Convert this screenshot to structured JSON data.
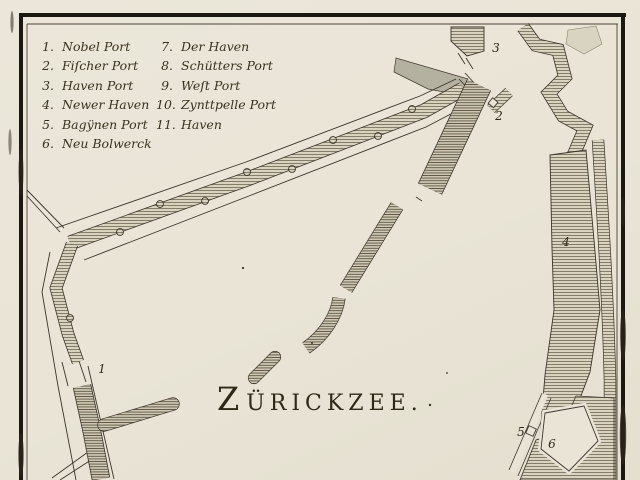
{
  "map": {
    "title": "ZÜRICKZEE.",
    "legend": {
      "col1": [
        {
          "num": "1.",
          "label": "Nobel Port"
        },
        {
          "num": "2.",
          "label": "Fiſcher Port"
        },
        {
          "num": "3.",
          "label": "Haven Port"
        },
        {
          "num": "4.",
          "label": "Newer Haven"
        },
        {
          "num": "5.",
          "label": "Bagÿnen Port"
        },
        {
          "num": "6.",
          "label": "Neu Bolwerck"
        }
      ],
      "col2": [
        {
          "num": "7.",
          "label": "Der Haven"
        },
        {
          "num": "8.",
          "label": "Schütters Port"
        },
        {
          "num": "9.",
          "label": "Weſt Port"
        },
        {
          "num": "10.",
          "label": "Zynttpelle Port"
        },
        {
          "num": "11.",
          "label": "Haven"
        }
      ]
    },
    "labels": [
      {
        "text": "1",
        "x": 102,
        "y": 369
      },
      {
        "text": "2",
        "x": 499,
        "y": 116
      },
      {
        "text": "3",
        "x": 496,
        "y": 48
      },
      {
        "text": "4",
        "x": 566,
        "y": 242
      },
      {
        "text": "5",
        "x": 521,
        "y": 432
      },
      {
        "text": "6",
        "x": 552,
        "y": 444
      }
    ],
    "colors": {
      "paper": "#e9e4d6",
      "ink": "#3a342a",
      "hatch_base": "#d8d2bf",
      "hatch_line": "#6e6754",
      "basin": "#b5b1a0",
      "frame": "#1b1711"
    }
  }
}
